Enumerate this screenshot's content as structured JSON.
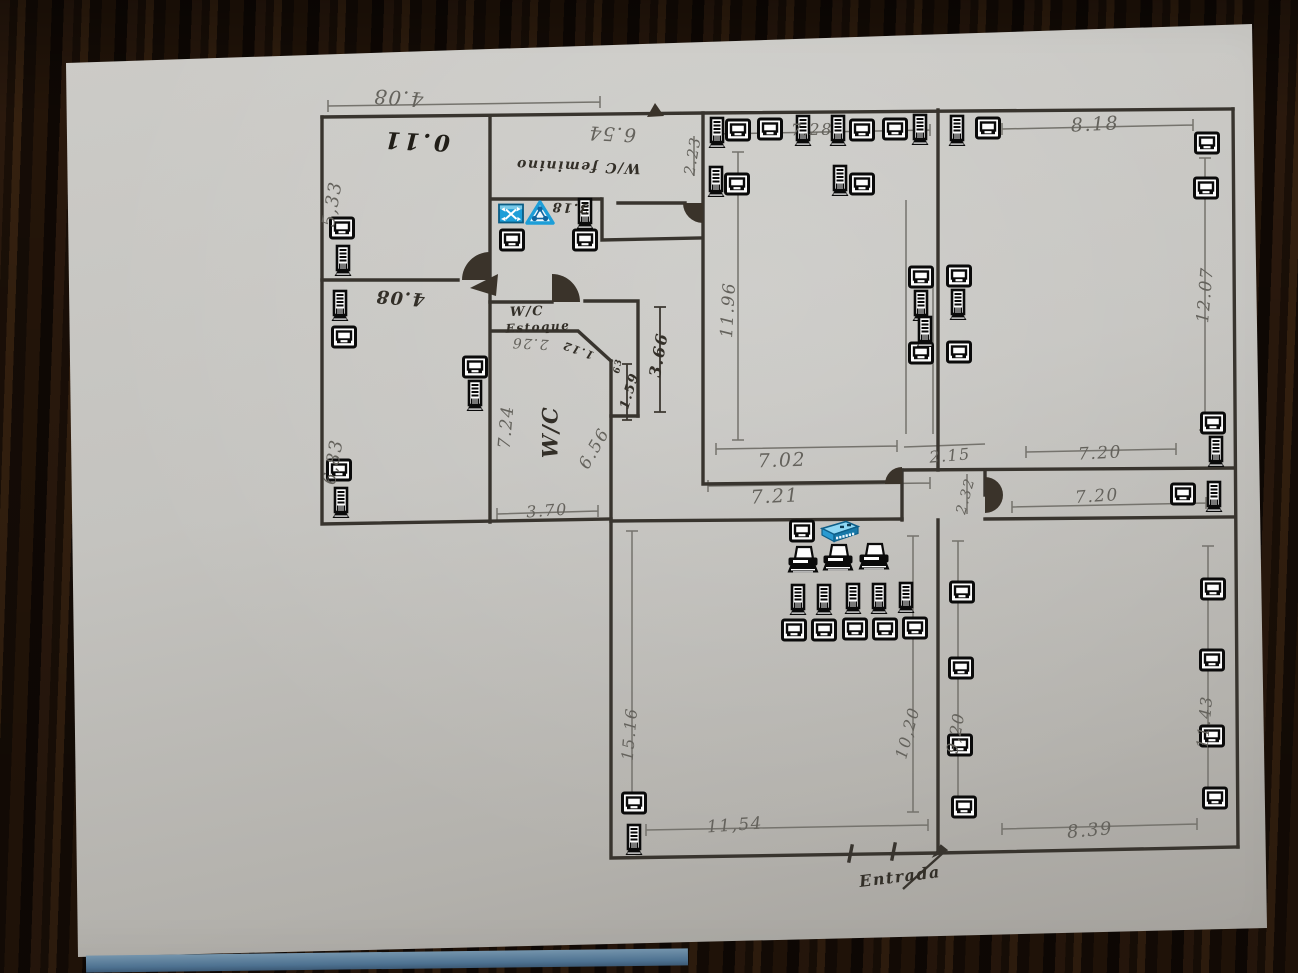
{
  "colors": {
    "wood_dark": "#1a0f07",
    "paper": "#c4c3bf",
    "ink": "#332f28",
    "pencil_gray": "#64625c",
    "icon_black": "#0a0a0a",
    "icon_blue": "#1d9ed8",
    "table_strip_blue": "#4d7190"
  },
  "icon_types": {
    "pc": "computer-monitor-icon",
    "tower": "computer-tower-icon",
    "printer": "printer-icon",
    "switch": "network-switch-icon",
    "router": "router-icon",
    "hub": "network-hub-icon"
  },
  "labels": [
    {
      "text": "4.08",
      "x": 398,
      "y": 98,
      "rot": 184,
      "size": 20,
      "cls": "pencil"
    },
    {
      "text": "0.11",
      "x": 416,
      "y": 141,
      "rot": 183,
      "size": 23,
      "cls": "ink0"
    },
    {
      "text": "5,33",
      "x": 333,
      "y": 204,
      "rot": -80,
      "size": 18,
      "cls": "pencil"
    },
    {
      "text": "6.54",
      "x": 612,
      "y": 133,
      "rot": 183,
      "size": 19,
      "cls": "pencil"
    },
    {
      "text": "W/C feminino",
      "x": 578,
      "y": 166,
      "rot": 182,
      "size": 14,
      "cls": "ink"
    },
    {
      "text": "2.23",
      "x": 693,
      "y": 156,
      "rot": -80,
      "size": 15,
      "cls": "pencil"
    },
    {
      "text": "3.18",
      "x": 570,
      "y": 207,
      "rot": 183,
      "size": 13,
      "cls": "ink"
    },
    {
      "text": "4.08",
      "x": 400,
      "y": 297,
      "rot": 184,
      "size": 18,
      "cls": "ink"
    },
    {
      "text": "6,83",
      "x": 334,
      "y": 462,
      "rot": -80,
      "size": 18,
      "cls": "pencil"
    },
    {
      "text": "W/C",
      "x": 527,
      "y": 312,
      "rot": -2,
      "size": 13,
      "cls": "ink"
    },
    {
      "text": "Estoque",
      "x": 538,
      "y": 327,
      "rot": -3,
      "size": 12,
      "cls": "ink"
    },
    {
      "text": "2.26",
      "x": 530,
      "y": 343,
      "rot": 183,
      "size": 14,
      "cls": "pencil"
    },
    {
      "text": "1.12",
      "x": 578,
      "y": 350,
      "rot": 200,
      "size": 11,
      "cls": "ink"
    },
    {
      "text": "7.24",
      "x": 507,
      "y": 427,
      "rot": -85,
      "size": 17,
      "cls": "pencil"
    },
    {
      "text": "W/C",
      "x": 550,
      "y": 432,
      "rot": -90,
      "size": 21,
      "cls": "ink"
    },
    {
      "text": "6.56",
      "x": 595,
      "y": 449,
      "rot": -60,
      "size": 17,
      "cls": "pencil"
    },
    {
      "text": "3.70",
      "x": 547,
      "y": 511,
      "rot": -4,
      "size": 16,
      "cls": "pencil"
    },
    {
      "text": "3.66",
      "x": 659,
      "y": 355,
      "rot": -80,
      "size": 16,
      "cls": "ink"
    },
    {
      "text": "1.59",
      "x": 630,
      "y": 391,
      "rot": -73,
      "size": 13,
      "cls": "ink"
    },
    {
      "text": "63",
      "x": 619,
      "y": 366,
      "rot": -80,
      "size": 9,
      "cls": "ink"
    },
    {
      "text": "11.96",
      "x": 729,
      "y": 310,
      "rot": -87,
      "size": 17,
      "cls": "pencil"
    },
    {
      "text": "7.28",
      "x": 812,
      "y": 130,
      "rot": -1,
      "size": 16,
      "cls": "pencil"
    },
    {
      "text": "8.18",
      "x": 1095,
      "y": 125,
      "rot": -3,
      "size": 19,
      "cls": "pencil"
    },
    {
      "text": "12.07",
      "x": 1206,
      "y": 295,
      "rot": -85,
      "size": 17,
      "cls": "pencil"
    },
    {
      "text": "7.02",
      "x": 782,
      "y": 461,
      "rot": -2,
      "size": 19,
      "cls": "pencil"
    },
    {
      "text": "7.21",
      "x": 775,
      "y": 497,
      "rot": -3,
      "size": 19,
      "cls": "pencil"
    },
    {
      "text": "2.15",
      "x": 950,
      "y": 456,
      "rot": -5,
      "size": 16,
      "cls": "pencil"
    },
    {
      "text": "2.32",
      "x": 966,
      "y": 496,
      "rot": -75,
      "size": 14,
      "cls": "pencil"
    },
    {
      "text": "7.20",
      "x": 1100,
      "y": 454,
      "rot": -3,
      "size": 17,
      "cls": "pencil"
    },
    {
      "text": "7.20",
      "x": 1097,
      "y": 497,
      "rot": -4,
      "size": 17,
      "cls": "pencil"
    },
    {
      "text": "15.16",
      "x": 630,
      "y": 734,
      "rot": -85,
      "size": 16,
      "cls": "pencil"
    },
    {
      "text": "10,20",
      "x": 908,
      "y": 733,
      "rot": -75,
      "size": 16,
      "cls": "pencil"
    },
    {
      "text": "9,20",
      "x": 956,
      "y": 733,
      "rot": -80,
      "size": 16,
      "cls": "pencil"
    },
    {
      "text": "11.43",
      "x": 1205,
      "y": 722,
      "rot": -85,
      "size": 16,
      "cls": "pencil"
    },
    {
      "text": "11,54",
      "x": 735,
      "y": 826,
      "rot": -4,
      "size": 17,
      "cls": "pencil"
    },
    {
      "text": "8.39",
      "x": 1090,
      "y": 831,
      "rot": -5,
      "size": 18,
      "cls": "pencil"
    },
    {
      "text": "Entrada",
      "x": 900,
      "y": 877,
      "rot": -7,
      "size": 16,
      "cls": "ink"
    }
  ],
  "icons": [
    {
      "type": "pc",
      "points": [
        [
          342,
          228
        ],
        [
          344,
          337
        ],
        [
          339,
          470
        ],
        [
          475,
          367
        ],
        [
          512,
          240
        ],
        [
          585,
          240
        ],
        [
          738,
          130
        ],
        [
          770,
          129
        ],
        [
          862,
          130
        ],
        [
          895,
          129
        ],
        [
          988,
          128
        ],
        [
          737,
          184
        ],
        [
          862,
          184
        ],
        [
          1207,
          143
        ],
        [
          1206,
          188
        ],
        [
          921,
          277
        ],
        [
          959,
          276
        ],
        [
          921,
          353
        ],
        [
          959,
          352
        ],
        [
          1213,
          423
        ],
        [
          1183,
          494
        ],
        [
          1213,
          589
        ],
        [
          1212,
          660
        ],
        [
          1212,
          736
        ],
        [
          1215,
          798
        ],
        [
          962,
          592
        ],
        [
          961,
          668
        ],
        [
          960,
          745
        ],
        [
          964,
          807
        ],
        [
          634,
          803
        ],
        [
          802,
          531
        ],
        [
          794,
          630
        ],
        [
          824,
          630
        ],
        [
          855,
          629
        ],
        [
          885,
          629
        ],
        [
          915,
          628
        ]
      ]
    },
    {
      "type": "tower",
      "points": [
        [
          343,
          261
        ],
        [
          340,
          306
        ],
        [
          341,
          503
        ],
        [
          475,
          396
        ],
        [
          585,
          214
        ],
        [
          717,
          133
        ],
        [
          803,
          131
        ],
        [
          838,
          131
        ],
        [
          920,
          130
        ],
        [
          957,
          131
        ],
        [
          716,
          182
        ],
        [
          840,
          181
        ],
        [
          921,
          306
        ],
        [
          958,
          305
        ],
        [
          925,
          332
        ],
        [
          1216,
          452
        ],
        [
          1214,
          497
        ],
        [
          634,
          840
        ],
        [
          798,
          600
        ],
        [
          824,
          600
        ],
        [
          853,
          599
        ],
        [
          879,
          599
        ],
        [
          906,
          598
        ]
      ]
    },
    {
      "type": "printer",
      "points": [
        [
          803,
          560
        ],
        [
          838,
          558
        ],
        [
          874,
          557
        ]
      ]
    },
    {
      "type": "switch",
      "points": [
        [
          840,
          531
        ]
      ]
    },
    {
      "type": "router",
      "points": [
        [
          511,
          213
        ]
      ]
    },
    {
      "type": "hub",
      "points": [
        [
          540,
          213
        ]
      ]
    }
  ]
}
